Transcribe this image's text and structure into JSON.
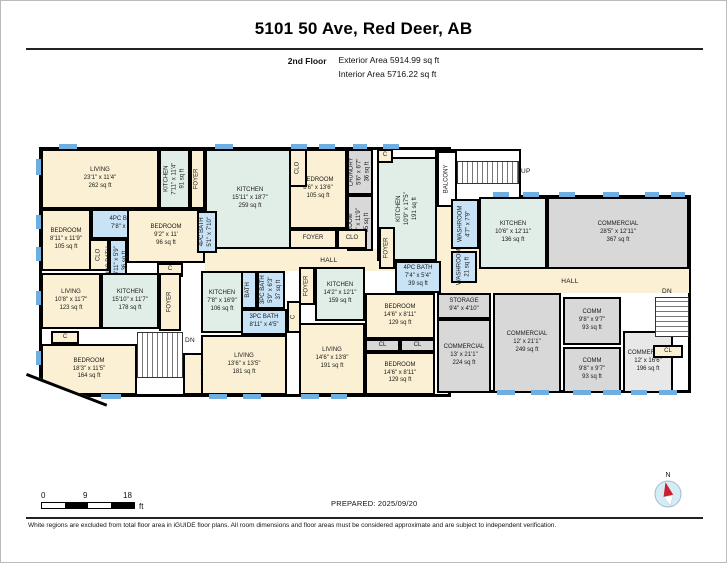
{
  "header": {
    "title": "5101 50 Ave, Red Deer, AB",
    "floor_label": "2nd Floor",
    "exterior_area": "Exterior Area 5914.99 sq ft",
    "interior_area": "Interior Area 5716.22 sq ft"
  },
  "colors": {
    "cream": "#FBF0D3",
    "kitchen": "#E1EDE7",
    "bath": "#C9E3F6",
    "gray": "#D8D8D8",
    "gray2": "#E8E8E8",
    "windowblue": "#6FAEE0",
    "wall": "#000000",
    "compassred": "#CC2030",
    "compassblue": "#D6ECF5"
  },
  "plan": {
    "buildings": [
      {
        "x": 38,
        "y": 146,
        "w": 412,
        "h": 250
      },
      {
        "x": 448,
        "y": 194,
        "w": 242,
        "h": 198
      }
    ],
    "balcony_outline": {
      "x": 434,
      "y": 148,
      "w": 86,
      "h": 60
    },
    "halls": [
      {
        "x": 204,
        "y": 248,
        "w": 248,
        "h": 22,
        "label": "HALL"
      },
      {
        "x": 450,
        "y": 268,
        "w": 238,
        "h": 24,
        "label": "HALL"
      },
      {
        "x": 436,
        "y": 206,
        "w": 16,
        "h": 64
      },
      {
        "x": 436,
        "y": 248,
        "w": 44,
        "h": 44
      }
    ],
    "rooms": [
      {
        "name": "LIVING",
        "dims": "23'1\" x 11'4\"",
        "area": "262 sq ft",
        "x": 40,
        "y": 148,
        "w": 118,
        "h": 60,
        "fill": "cream"
      },
      {
        "name": "KITCHEN",
        "dims": "7'11\" x 11'4\"",
        "area": "91 sq ft",
        "x": 158,
        "y": 148,
        "w": 31,
        "h": 60,
        "fill": "kitchen",
        "vert": true
      },
      {
        "name": "FOYER",
        "x": 189,
        "y": 148,
        "w": 15,
        "h": 60,
        "fill": "cream",
        "vert": true
      },
      {
        "name": "BEDROOM",
        "dims": "8'11\" x 11'9\"",
        "area": "105 sq ft",
        "x": 40,
        "y": 208,
        "w": 50,
        "h": 62,
        "fill": "cream"
      },
      {
        "name": "4PC BATH",
        "dims": "7'8\" x 5'1\"",
        "x": 90,
        "y": 208,
        "w": 66,
        "h": 30,
        "fill": "bath"
      },
      {
        "name": "BEDROOM",
        "dims": "9'2\" x 11'",
        "area": "96 sq ft",
        "x": 126,
        "y": 208,
        "w": 78,
        "h": 54,
        "fill": "cream"
      },
      {
        "name": "CLO",
        "x": 88,
        "y": 238,
        "w": 20,
        "h": 32,
        "fill": "cream",
        "vert": true
      },
      {
        "name": "4PC BATH",
        "dims": "4'11\" x 5'9\"",
        "area": "36 sq ft",
        "x": 108,
        "y": 238,
        "w": 18,
        "h": 44,
        "fill": "bath",
        "vert": true
      },
      {
        "name": "C",
        "x": 156,
        "y": 262,
        "w": 26,
        "h": 14,
        "fill": "cream"
      },
      {
        "name": "LIVING",
        "dims": "10'8\" x 11'7\"",
        "area": "123 sq ft",
        "x": 40,
        "y": 272,
        "w": 60,
        "h": 56,
        "fill": "cream"
      },
      {
        "name": "KITCHEN",
        "dims": "15'10\" x 11'7\"",
        "area": "178 sq ft",
        "x": 100,
        "y": 272,
        "w": 58,
        "h": 56,
        "fill": "kitchen"
      },
      {
        "name": "FOYER",
        "x": 158,
        "y": 272,
        "w": 22,
        "h": 58,
        "fill": "cream",
        "vert": true
      },
      {
        "name": "C",
        "x": 50,
        "y": 330,
        "w": 28,
        "h": 13,
        "fill": "cream"
      },
      {
        "name": "BEDROOM",
        "dims": "18'3\" x 11'5\"",
        "area": "164 sq ft",
        "x": 40,
        "y": 343,
        "w": 96,
        "h": 51,
        "fill": "cream"
      },
      {
        "name": "OFFICE",
        "dims": "14'9\" x 8'3\"",
        "area": "121 sq ft",
        "x": 182,
        "y": 352,
        "w": 64,
        "h": 42,
        "fill": "cream"
      },
      {
        "name": "KITCHEN",
        "dims": "15'11\" x 18'7\"",
        "area": "259 sq ft",
        "x": 204,
        "y": 148,
        "w": 90,
        "h": 100,
        "fill": "kitchen"
      },
      {
        "name": "4PC BATH",
        "dims": "5'1\" x 7'10\"",
        "x": 196,
        "y": 210,
        "w": 20,
        "h": 42,
        "fill": "bath",
        "vert": true
      },
      {
        "name": "BEDROOM",
        "dims": "8'6\" x 13'6\"",
        "area": "105 sq ft",
        "x": 288,
        "y": 148,
        "w": 58,
        "h": 80,
        "fill": "cream"
      },
      {
        "name": "CLO",
        "x": 288,
        "y": 148,
        "w": 18,
        "h": 38,
        "fill": "cream",
        "vert": true
      },
      {
        "name": "LAUNDRY",
        "dims": "5'6\" x 6'7\"",
        "area": "36 sq ft",
        "x": 346,
        "y": 148,
        "w": 26,
        "h": 46,
        "fill": "gray",
        "vert": true
      },
      {
        "name": "ROOM",
        "dims": "5'6\" x 11'9\"",
        "area": "65 sq ft",
        "x": 346,
        "y": 194,
        "w": 26,
        "h": 56,
        "fill": "gray",
        "vert": true
      },
      {
        "name": "FOYER",
        "x": 288,
        "y": 228,
        "w": 48,
        "h": 20,
        "fill": "cream"
      },
      {
        "name": "CLO",
        "x": 336,
        "y": 228,
        "w": 30,
        "h": 20,
        "fill": "cream"
      },
      {
        "name": "KITCHEN",
        "dims": "10'9\" x 17'5\"",
        "area": "191 sq ft",
        "x": 376,
        "y": 156,
        "w": 60,
        "h": 104,
        "fill": "kitchen",
        "vert": true
      },
      {
        "name": "C",
        "x": 376,
        "y": 148,
        "w": 16,
        "h": 14,
        "fill": "cream"
      },
      {
        "name": "FOYER",
        "x": 378,
        "y": 226,
        "w": 16,
        "h": 42,
        "fill": "cream",
        "vert": true
      },
      {
        "name": "BALCONY",
        "x": 436,
        "y": 150,
        "w": 20,
        "h": 56,
        "fill": "white",
        "vert": true
      },
      {
        "name": "4PC BATH",
        "dims": "7'4\" x 5'4\"",
        "area": "39 sq ft",
        "x": 394,
        "y": 260,
        "w": 46,
        "h": 32,
        "fill": "bath"
      },
      {
        "name": "WASHROOM",
        "dims": "4'7\" x 7'9\"",
        "x": 450,
        "y": 198,
        "w": 28,
        "h": 50,
        "fill": "bath",
        "vert": true
      },
      {
        "name": "WASHROOM",
        "area": "21 sq ft",
        "x": 450,
        "y": 250,
        "w": 26,
        "h": 32,
        "fill": "bath",
        "vert": true
      },
      {
        "name": "KITCHEN",
        "dims": "10'6\" x 12'11\"",
        "area": "136 sq ft",
        "x": 478,
        "y": 196,
        "w": 68,
        "h": 72,
        "fill": "kitchen"
      },
      {
        "name": "COMMERCIAL",
        "dims": "28'5\" x 12'11\"",
        "area": "367 sq ft",
        "x": 546,
        "y": 196,
        "w": 142,
        "h": 72,
        "fill": "gray"
      },
      {
        "name": "KITCHEN",
        "dims": "7'8\" x 16'9\"",
        "area": "106 sq ft",
        "x": 200,
        "y": 270,
        "w": 42,
        "h": 62,
        "fill": "kitchen"
      },
      {
        "name": "BATH",
        "x": 240,
        "y": 270,
        "w": 16,
        "h": 38,
        "fill": "bath",
        "vert": true
      },
      {
        "name": "3PC BATH",
        "dims": "5'9\" x 6'3\"",
        "area": "37 sq ft",
        "x": 256,
        "y": 270,
        "w": 28,
        "h": 38,
        "fill": "bath",
        "vert": true
      },
      {
        "name": "3PC BATH",
        "dims": "8'11\" x 4'5\"",
        "x": 240,
        "y": 308,
        "w": 46,
        "h": 26,
        "fill": "bath"
      },
      {
        "name": "C",
        "x": 286,
        "y": 300,
        "w": 14,
        "h": 32,
        "fill": "cream",
        "vert": true
      },
      {
        "name": "FOYER",
        "x": 298,
        "y": 266,
        "w": 16,
        "h": 38,
        "fill": "cream",
        "vert": true
      },
      {
        "name": "KITCHEN",
        "dims": "14'2\" x 12'1\"",
        "area": "159 sq ft",
        "x": 314,
        "y": 266,
        "w": 50,
        "h": 54,
        "fill": "kitchen"
      },
      {
        "name": "LIVING",
        "dims": "13'6\" x 13'5\"",
        "area": "181 sq ft",
        "x": 200,
        "y": 334,
        "w": 86,
        "h": 60,
        "fill": "cream"
      },
      {
        "name": "LIVING",
        "dims": "14'6\" x 13'8\"",
        "area": "191 sq ft",
        "x": 298,
        "y": 322,
        "w": 66,
        "h": 72,
        "fill": "cream"
      },
      {
        "name": "BEDROOM",
        "dims": "14'6\" x 8'11\"",
        "area": "129 sq ft",
        "x": 364,
        "y": 292,
        "w": 70,
        "h": 46,
        "fill": "cream"
      },
      {
        "name": "CL",
        "x": 364,
        "y": 338,
        "w": 35,
        "h": 13,
        "fill": "gray"
      },
      {
        "name": "CL",
        "x": 399,
        "y": 338,
        "w": 35,
        "h": 13,
        "fill": "gray"
      },
      {
        "name": "BEDROOM",
        "dims": "14'6\" x 8'11\"",
        "area": "129 sq ft",
        "x": 364,
        "y": 351,
        "w": 70,
        "h": 43,
        "fill": "cream"
      },
      {
        "name": "STORAGE",
        "dims": "9'4\" x 4'10\"",
        "x": 436,
        "y": 292,
        "w": 54,
        "h": 26,
        "fill": "gray"
      },
      {
        "name": "COMMERCIAL",
        "dims": "13' x 21'1\"",
        "area": "224 sq ft",
        "x": 436,
        "y": 318,
        "w": 54,
        "h": 74,
        "fill": "gray"
      },
      {
        "name": "COMMERCIAL",
        "dims": "12' x 21'1\"",
        "area": "249 sq ft",
        "x": 492,
        "y": 292,
        "w": 68,
        "h": 100,
        "fill": "gray"
      },
      {
        "name": "COMM",
        "dims": "9'8\" x 9'7\"",
        "area": "93 sq ft",
        "x": 562,
        "y": 296,
        "w": 58,
        "h": 48,
        "fill": "gray"
      },
      {
        "name": "COMM",
        "dims": "9'8\" x 9'7\"",
        "area": "93 sq ft",
        "x": 562,
        "y": 346,
        "w": 58,
        "h": 46,
        "fill": "gray"
      },
      {
        "name": "COMMERCIAL",
        "dims": "12' x 16'6\"",
        "area": "196 sq ft",
        "x": 622,
        "y": 330,
        "w": 50,
        "h": 62,
        "fill": "gray2"
      },
      {
        "name": "CL",
        "x": 652,
        "y": 344,
        "w": 30,
        "h": 13,
        "fill": "cream"
      }
    ],
    "stairs": [
      {
        "x": 456,
        "y": 160,
        "w": 62,
        "h": 23,
        "dir": "h"
      },
      {
        "x": 136,
        "y": 331,
        "w": 46,
        "h": 46,
        "dir": "h"
      },
      {
        "x": 654,
        "y": 296,
        "w": 34,
        "h": 40,
        "dir": "v"
      }
    ],
    "labels": [
      {
        "text": "UP",
        "x": 520,
        "y": 167
      },
      {
        "text": "DN",
        "x": 184,
        "y": 336
      },
      {
        "text": "DN",
        "x": 661,
        "y": 287
      }
    ],
    "windows": [
      {
        "x": 58,
        "y": 143,
        "w": 18,
        "h": 5
      },
      {
        "x": 214,
        "y": 143,
        "w": 18,
        "h": 5
      },
      {
        "x": 290,
        "y": 143,
        "w": 16,
        "h": 5
      },
      {
        "x": 318,
        "y": 143,
        "w": 16,
        "h": 5
      },
      {
        "x": 352,
        "y": 143,
        "w": 14,
        "h": 5
      },
      {
        "x": 382,
        "y": 143,
        "w": 16,
        "h": 5
      },
      {
        "x": 35,
        "y": 158,
        "w": 5,
        "h": 16
      },
      {
        "x": 35,
        "y": 214,
        "w": 5,
        "h": 14
      },
      {
        "x": 35,
        "y": 246,
        "w": 5,
        "h": 14
      },
      {
        "x": 35,
        "y": 290,
        "w": 5,
        "h": 14
      },
      {
        "x": 35,
        "y": 350,
        "w": 5,
        "h": 14
      },
      {
        "x": 100,
        "y": 393,
        "w": 20,
        "h": 5
      },
      {
        "x": 208,
        "y": 393,
        "w": 18,
        "h": 5
      },
      {
        "x": 242,
        "y": 393,
        "w": 18,
        "h": 5
      },
      {
        "x": 300,
        "y": 393,
        "w": 18,
        "h": 5
      },
      {
        "x": 330,
        "y": 393,
        "w": 16,
        "h": 5
      },
      {
        "x": 492,
        "y": 191,
        "w": 16,
        "h": 5
      },
      {
        "x": 522,
        "y": 191,
        "w": 16,
        "h": 5
      },
      {
        "x": 558,
        "y": 191,
        "w": 16,
        "h": 5
      },
      {
        "x": 602,
        "y": 191,
        "w": 16,
        "h": 5
      },
      {
        "x": 644,
        "y": 191,
        "w": 14,
        "h": 5
      },
      {
        "x": 670,
        "y": 191,
        "w": 14,
        "h": 5
      },
      {
        "x": 496,
        "y": 389,
        "w": 18,
        "h": 5
      },
      {
        "x": 530,
        "y": 389,
        "w": 18,
        "h": 5
      },
      {
        "x": 572,
        "y": 389,
        "w": 18,
        "h": 5
      },
      {
        "x": 602,
        "y": 389,
        "w": 18,
        "h": 5
      },
      {
        "x": 630,
        "y": 389,
        "w": 16,
        "h": 5
      },
      {
        "x": 658,
        "y": 389,
        "w": 18,
        "h": 5
      }
    ],
    "diagonal": {
      "x": 26,
      "y": 372,
      "w": 86,
      "h": 36,
      "angle": 21
    }
  },
  "scale_bar": {
    "labels": [
      "0",
      "9",
      "18"
    ],
    "unit": "ft"
  },
  "footer": {
    "prepared": "PREPARED: 2025/09/20",
    "disclaimer": "White regions are excluded from total floor area in iGUIDE floor plans. All room dimensions and floor areas must be considered approximate and are subject to independent verification."
  },
  "compass": {
    "label": "N"
  }
}
